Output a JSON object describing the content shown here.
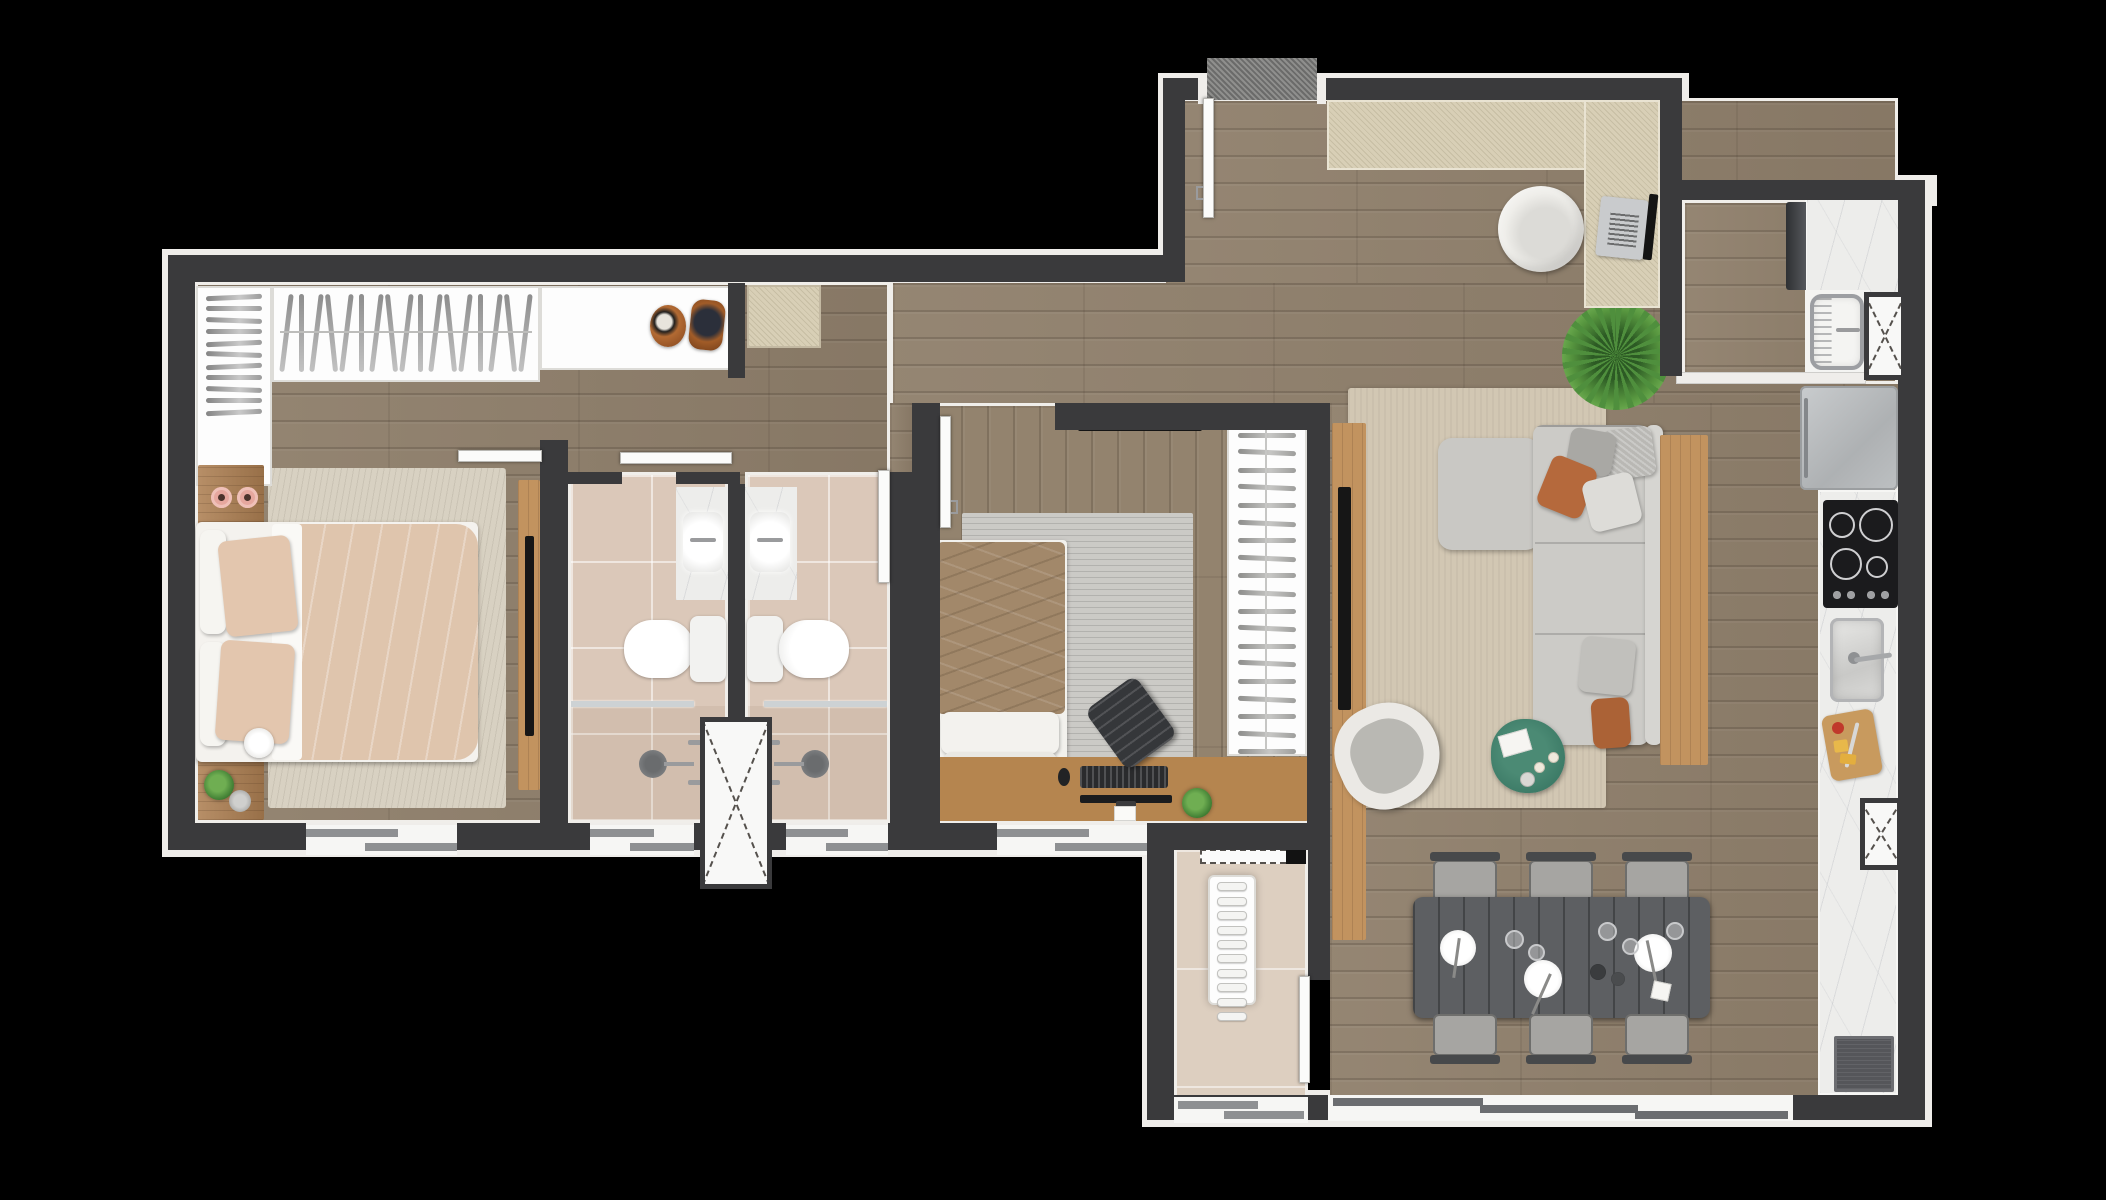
{
  "meta": {
    "type": "apartment-floor-plan-render",
    "view": "top-down",
    "background_color": "#000000",
    "visible_text": ""
  },
  "palette": {
    "wall": "#3a3a3c",
    "wall_lining": "#efedea",
    "wood_floor": "#8f7f6b",
    "bath_tile": "#dbc8b9",
    "laundry_tile": "#ddcfc0",
    "marble_counter": "#ededeb",
    "rug_living": "#d2c7b3",
    "rug_bedroom1": "#d8d1c2",
    "rug_bedroom2": "#cbcac6",
    "sofa": "#c9c8c4",
    "terracotta_cushion": "#b5693c",
    "wood_furniture": "#ad7f52",
    "dining_table": "#5d5f62",
    "coffee_table_green": "#3c7a66",
    "plant_green": "#4f8f3d",
    "candle_pink": "#e6a79e",
    "doormat_gray": "#8f8f8d",
    "office_mat_beige": "#d8cfb6"
  },
  "patterns": {
    "closet_shelf_bars": 11,
    "closet_hangers": 17,
    "wardrobe_hangers": 19,
    "drying_rack_rungs": 10
  },
  "counts": {
    "bedrooms": 2,
    "bathrooms": 2,
    "dining_chairs": 6,
    "ventilation_shafts": 3,
    "windows": 5,
    "cooktop_burners": 4
  },
  "rooms": [
    {
      "id": "bedroom-1",
      "furniture": [
        "double-bed",
        "rug",
        "nightstand-top",
        "nightstand-bottom",
        "candles",
        "plant",
        "table-lamp",
        "tv-panel",
        "closet-shelves",
        "closet-hanging-rail",
        "bags",
        "entry-bench-mat",
        "window"
      ]
    },
    {
      "id": "bathroom-1",
      "furniture": [
        "vanity-marble",
        "sink",
        "toilet",
        "shower-head",
        "shower-glass",
        "window"
      ]
    },
    {
      "id": "bathroom-2",
      "furniture": [
        "vanity-marble",
        "sink",
        "toilet",
        "shower-head",
        "shower-glass",
        "window",
        "door"
      ]
    },
    {
      "id": "bedroom-2",
      "furniture": [
        "single-bed",
        "rug",
        "desk",
        "desk-chair",
        "keyboard",
        "mouse",
        "monitor",
        "plant",
        "wardrobe",
        "tv",
        "window",
        "door"
      ]
    },
    {
      "id": "living-room",
      "furniture": [
        "sectional-sofa",
        "cushions",
        "swivel-armchair",
        "coffee-table",
        "book",
        "tv-panel",
        "sideboard",
        "rug",
        "palm-plant"
      ]
    },
    {
      "id": "dining-area",
      "furniture": [
        "dining-table",
        "six-chairs",
        "plates",
        "glasses",
        "bottles",
        "napkin",
        "balcony-sliding-door"
      ]
    },
    {
      "id": "home-office",
      "furniture": [
        "corner-desk",
        "office-chair",
        "laptop"
      ]
    },
    {
      "id": "kitchen",
      "furniture": [
        "refrigerator",
        "cooktop",
        "counter-marble",
        "sink",
        "cutting-board",
        "floor-mat",
        "ventilation-shaft"
      ]
    },
    {
      "id": "service-area",
      "furniture": [
        "washing-machine",
        "marble-counter",
        "laundry-tank-sink",
        "ventilation-shaft",
        "sliding-door"
      ]
    },
    {
      "id": "laundry-room",
      "furniture": [
        "drying-rack",
        "dashed-overhead-cabinet",
        "door",
        "window"
      ]
    },
    {
      "id": "entry",
      "furniture": [
        "entry-door",
        "doormat"
      ]
    }
  ]
}
